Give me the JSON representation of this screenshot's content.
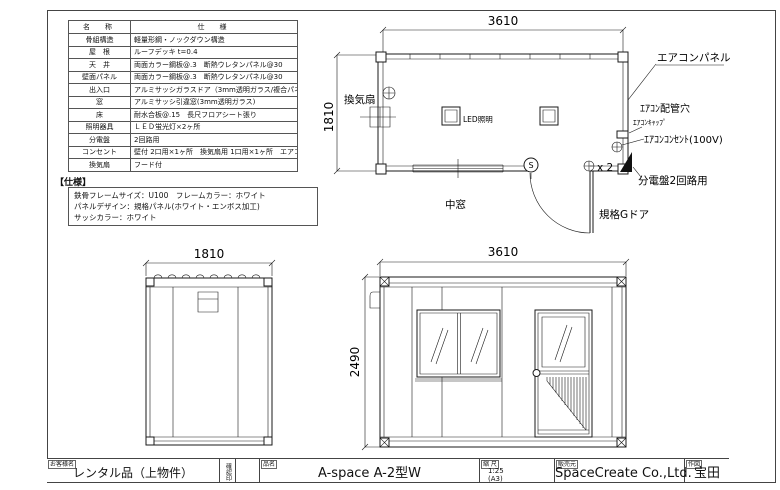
{
  "spec_table": {
    "header": {
      "name": "名　称",
      "spec": "仕　様"
    },
    "rows": [
      {
        "name": "骨組構造",
        "spec": "軽量形鋼・ノックダウン構造"
      },
      {
        "name": "屋　根",
        "spec": "ルーフデッキ t=0.4"
      },
      {
        "name": "天　井",
        "spec": "両面カラー鋼板@.3　断熱ウレタンパネル@30"
      },
      {
        "name": "壁面パネル",
        "spec": "両面カラー鋼板@.3　断熱ウレタンパネル@30"
      },
      {
        "name": "出入口",
        "spec": "アルミサッシガラスドア（3mm透明ガラス/複合パネル）"
      },
      {
        "name": "窓",
        "spec": "アルミサッシ引違窓(3mm透明ガラス)"
      },
      {
        "name": "床",
        "spec": "耐水合板@.15　長尺フロアシート張り"
      },
      {
        "name": "照明器具",
        "spec": "ＬＥＤ蛍光灯×2ヶ所"
      },
      {
        "name": "分電盤",
        "spec": "2回路用"
      },
      {
        "name": "コンセント",
        "spec": "壁付 2口用×1ヶ所　換気扇用 1口用×1ヶ所　エアコン用：1口×1ヶ所"
      },
      {
        "name": "換気扇",
        "spec": "フード付"
      }
    ]
  },
  "notes": {
    "title": "【仕様】",
    "lines": [
      {
        "text": "鉄骨フレームサイズ：U100　フレームカラー：ホワイト"
      },
      {
        "text": "パネルデザイン：規格パネル(ホワイト・エンボス加工)"
      },
      {
        "text": "サッシカラー：ホワイト"
      }
    ]
  },
  "plan": {
    "dim_width": "3610",
    "dim_depth": "1810",
    "labels": {
      "vent_fan": "換気扇",
      "led": "LED照明",
      "mid_window": "中窓",
      "door": "規格Gドア",
      "ac_panel": "エアコンパネル",
      "ac_pipe_hole": "ｴｱｺﾝ配管穴",
      "ac_cap": "ｴｱｺﾝｷｬｯﾌﾟ",
      "ac_outlet": "ｴｱｺﾝｺﾝｾﾝﾄ(100V)",
      "breaker": "分電盤2回路用",
      "outlet_x2": "x 2",
      "switch": "S"
    }
  },
  "side_elevation": {
    "dim_width": "1810"
  },
  "front_elevation": {
    "dim_width": "3610",
    "dim_height": "2490"
  },
  "title_block": {
    "customer_label": "お客様名",
    "customer": "レンタル品（上物件）",
    "stamp_label": "確認印",
    "product_label": "品名",
    "product": "A-space A-2型W",
    "scale_label": "縮 尺",
    "scale": "1:25",
    "scale_size": "(A3)",
    "maker_label": "販売元",
    "maker": "SpaceCreate Co.,Ltd.",
    "drawer_label": "作図",
    "drawer": "宝田"
  }
}
